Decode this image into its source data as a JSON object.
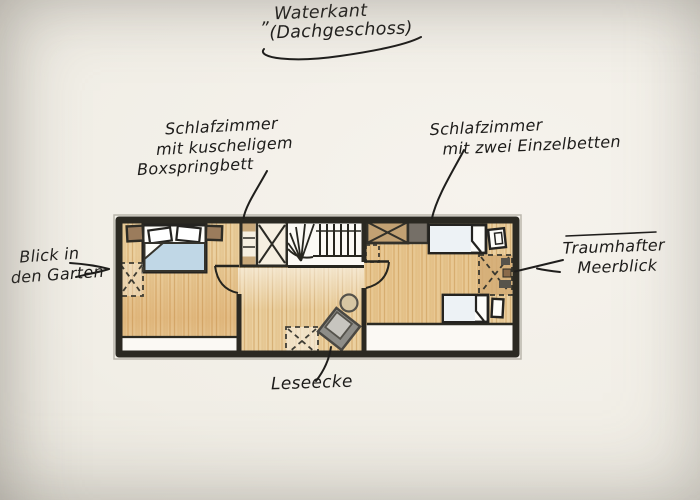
{
  "title": {
    "quote_mark": "„",
    "line1": "Waterkant",
    "line2": "(Dachgeschoss)"
  },
  "annotations": {
    "bedroom1": [
      "Schlafzimmer",
      "mit kuscheligem",
      "Boxspringbett"
    ],
    "bedroom2": [
      "Schlafzimmer",
      "mit zwei Einzelbetten"
    ],
    "garden_view": [
      "Blick in",
      "den Garten"
    ],
    "sea_view": [
      "Traumhafter",
      "Meerblick"
    ],
    "reading_corner": "Leseecke"
  },
  "floorplan": {
    "type": "hand-drawn attic floor plan sketch",
    "rooms": [
      "bedroom-with-boxspring-bed",
      "landing-with-staircase-and-reading-corner",
      "bedroom-with-two-single-beds"
    ],
    "elements": [
      "double-bed",
      "pillows",
      "blue-duvet",
      "nightstand-left",
      "nightstand-right",
      "garden-window-dashed",
      "built-in-closet",
      "winder-staircase",
      "stair-railing",
      "door-arc-bedroom1",
      "door-arc-bedroom2",
      "rug-dashed",
      "reading-armchair",
      "side-table",
      "wardrobe",
      "single-bed-top",
      "single-bed-bottom",
      "bedside-table-top",
      "bedside-table-bottom",
      "sea-window-dashed",
      "knee-wall-strips"
    ],
    "colors": {
      "paper": "#f1eee6",
      "wall_ink": "#2b2922",
      "wood_floor": "#ebd0a0",
      "wood_grain": "#c3914e",
      "duvet_blue": "#c0d7e6",
      "armchair_gray": "#8e8d88",
      "wardrobe_brown": "#c2a173",
      "nightstand_brown": "#9b7c5c",
      "white_area": "#fbf9f4"
    }
  }
}
